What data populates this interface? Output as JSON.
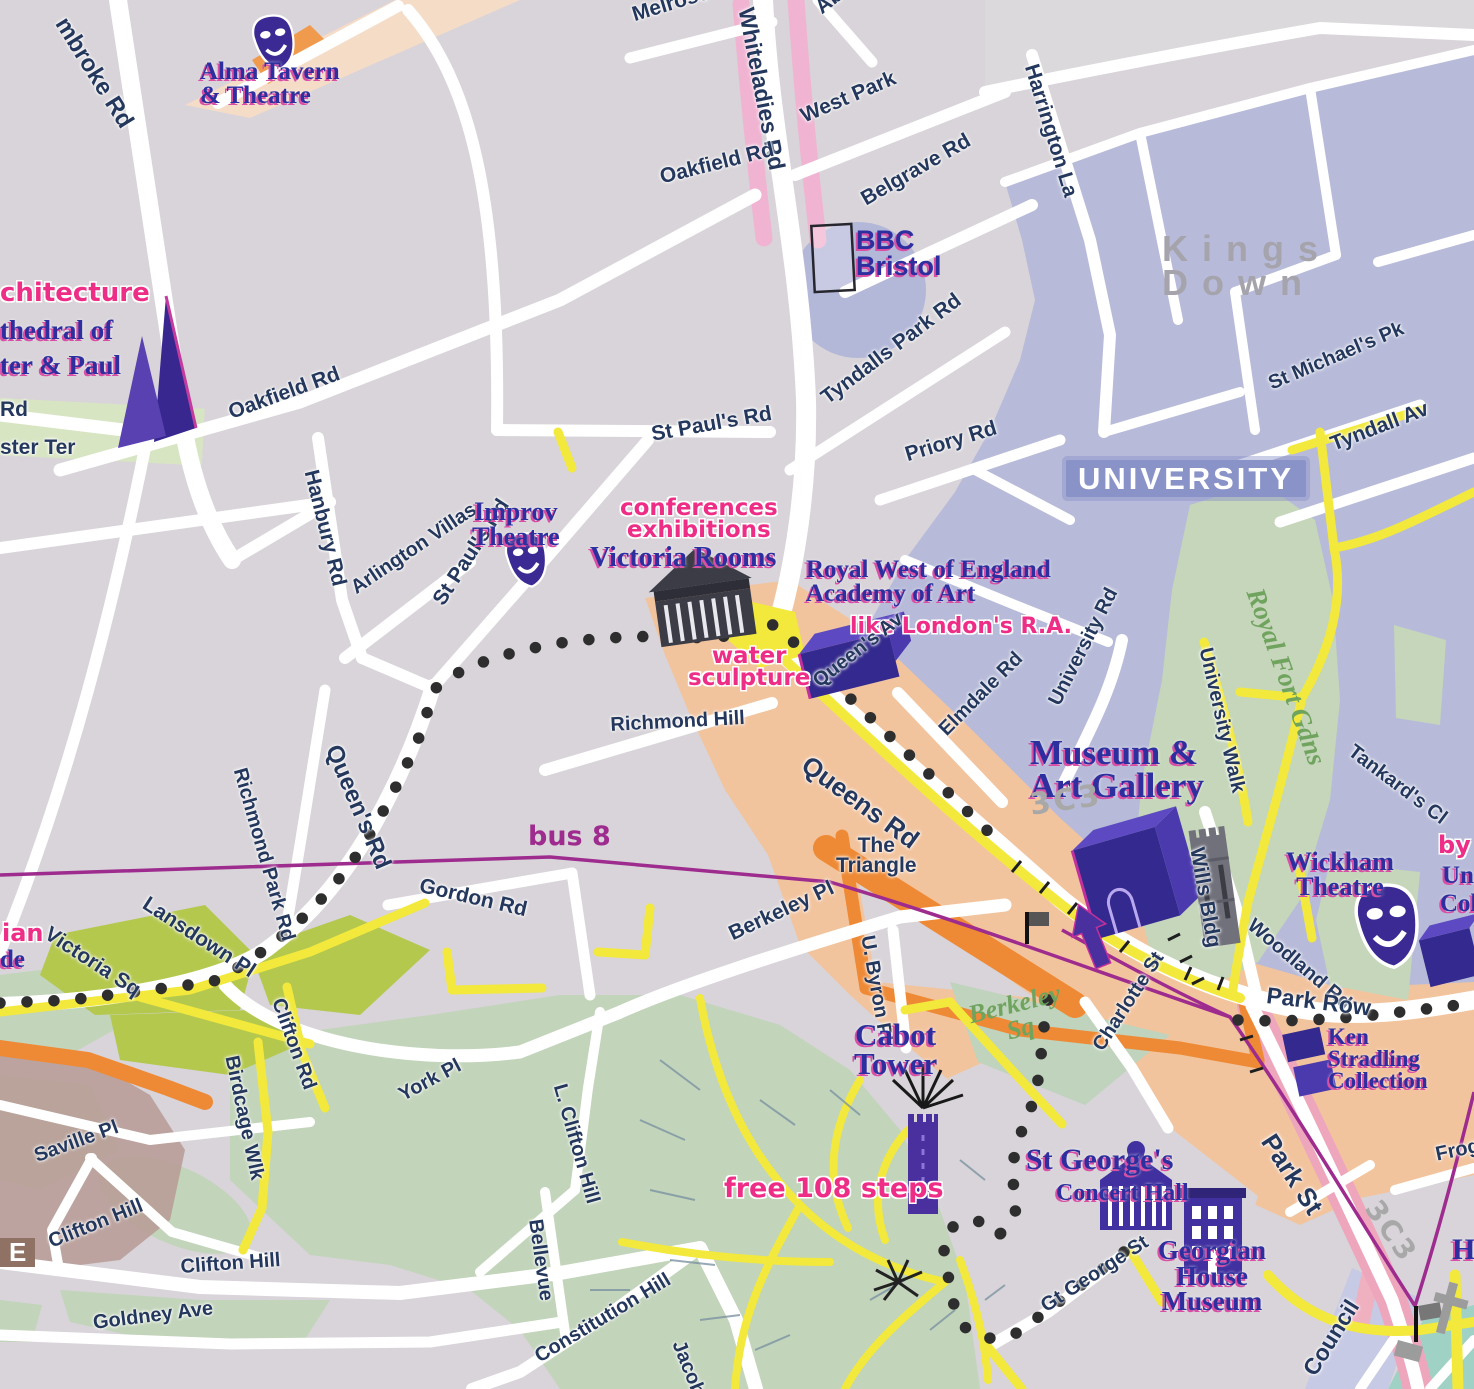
{
  "map": {
    "title": "Bristol visitor map — Clifton / University / Brandon Hill area",
    "colors": {
      "background": "#d8d4d9",
      "university_district": "#b7bbd9",
      "district_chip": "#8a93c8",
      "shopping_district": "#f2c49e",
      "park_green": "#c3d5bb",
      "square_olive": "#b5c84e",
      "road_white": "#ffffff",
      "road_yellow": "#f2e93c",
      "road_orange": "#ee8a35",
      "road_pink_shading": "#f0b4d2",
      "bus_route_purple": "#9e2b8e",
      "walking_trail_dots": "#2e2e2e",
      "poi_text_blue": "#2d2f9f",
      "poi_shadow_pink": "#d94fa5",
      "note_pink": "#ee2d87",
      "street_text_navy": "#24375c",
      "district_text_gray": "#a5a3ab",
      "building_icon_indigo": "#33298e"
    },
    "legend_icons": [
      "theatre-masks-icon",
      "cathedral-icon",
      "classical-building-icon",
      "3d-building-block-icon",
      "tower-icon",
      "viewpoint-starburst-icon",
      "bus-stop-flag-icon",
      "route-arrow-icon",
      "church-cross-icon"
    ],
    "routes": {
      "bus_route_label": "bus 8",
      "walking_trail_style": "black dotted line"
    },
    "labels": [
      {
        "n": "street-pembroke-rd",
        "t": "mbroke Rd",
        "x": 70,
        "y": 14,
        "r": 58,
        "c": "street-big",
        "s": 24
      },
      {
        "n": "poi-alma-tavern-theatre",
        "t": "Alma Tavern\n& Theatre",
        "x": 200,
        "y": 60,
        "r": 0,
        "c": "poi",
        "s": 25
      },
      {
        "n": "street-melrose-pl",
        "t": "Melrose Pl",
        "x": 630,
        "y": 6,
        "r": -17,
        "c": "street",
        "s": 21
      },
      {
        "n": "street-whiteladies-rd",
        "t": "Whiteladies Rd",
        "x": 756,
        "y": 6,
        "r": 79,
        "c": "street-big",
        "s": 23
      },
      {
        "n": "street-aberdeen-rd",
        "t": "Aberdeen",
        "x": 812,
        "y": 2,
        "r": -38,
        "c": "street",
        "s": 21
      },
      {
        "n": "street-west-park",
        "t": "West Park",
        "x": 798,
        "y": 108,
        "r": -23,
        "c": "street",
        "s": 21
      },
      {
        "n": "street-oakfield-rd-north",
        "t": "Oakfield Rd",
        "x": 658,
        "y": 168,
        "r": -14,
        "c": "street",
        "s": 21
      },
      {
        "n": "street-belgrave-rd",
        "t": "Belgrave Rd",
        "x": 858,
        "y": 192,
        "r": -30,
        "c": "street",
        "s": 21
      },
      {
        "n": "poi-bbc-bristol",
        "t": "BBC\nBristol",
        "x": 856,
        "y": 228,
        "r": 0,
        "c": "poi-sans",
        "s": 27
      },
      {
        "n": "street-harrington-la",
        "t": "Harrington La",
        "x": 1040,
        "y": 62,
        "r": 73,
        "c": "street",
        "s": 21
      },
      {
        "n": "district-kings-down",
        "t": "Kings Down",
        "x": 1162,
        "y": 232,
        "r": 0,
        "c": "district",
        "s": 36
      },
      {
        "n": "street-st-michaels-pk",
        "t": "St Michael's Pk",
        "x": 1266,
        "y": 376,
        "r": -23,
        "c": "street",
        "s": 20
      },
      {
        "n": "street-tyndall-av",
        "t": "Tyndall Av",
        "x": 1328,
        "y": 436,
        "r": -21,
        "c": "street",
        "s": 21
      },
      {
        "n": "note-architecture-partial",
        "t": "chitecture",
        "x": 0,
        "y": 281,
        "r": 0,
        "c": "pink",
        "s": 26
      },
      {
        "n": "poi-cathedral-line1",
        "t": "thedral of",
        "x": 0,
        "y": 318,
        "r": 0,
        "c": "poi",
        "s": 27
      },
      {
        "n": "poi-cathedral-line2",
        "t": "ter & Paul",
        "x": 0,
        "y": 353,
        "r": 0,
        "c": "poi",
        "s": 27
      },
      {
        "n": "street-rd-partial",
        "t": "Rd",
        "x": 0,
        "y": 400,
        "r": 0,
        "c": "street",
        "s": 21
      },
      {
        "n": "street-ster-ter-partial",
        "t": "ster Ter",
        "x": 0,
        "y": 438,
        "r": 0,
        "c": "street",
        "s": 21
      },
      {
        "n": "street-priory-rd",
        "t": "Priory Rd",
        "x": 903,
        "y": 446,
        "r": -17,
        "c": "street",
        "s": 21
      },
      {
        "n": "street-tyndalls-park-rd",
        "t": "Tyndalls Park Rd",
        "x": 818,
        "y": 392,
        "r": -37,
        "c": "street",
        "s": 21
      },
      {
        "n": "street-hanbury-rd",
        "t": "Hanbury Rd",
        "x": 320,
        "y": 468,
        "r": 76,
        "c": "street",
        "s": 21
      },
      {
        "n": "street-arlington-villas",
        "t": "Arlington Villas",
        "x": 348,
        "y": 582,
        "r": -34,
        "c": "street",
        "s": 20
      },
      {
        "n": "street-st-pauls-rd-west",
        "t": "St Paul's Rd",
        "x": 430,
        "y": 598,
        "r": -57,
        "c": "street",
        "s": 21
      },
      {
        "n": "street-st-pauls-rd-north",
        "t": "St Paul's Rd",
        "x": 650,
        "y": 425,
        "r": -10,
        "c": "street",
        "s": 21
      },
      {
        "n": "poi-improv-theatre",
        "t": "Improv\nTheatre",
        "x": 472,
        "y": 500,
        "r": 0,
        "c": "poi ctr",
        "s": 26
      },
      {
        "n": "note-conferences-exhibitions",
        "t": "conferences\nexhibitions",
        "x": 620,
        "y": 498,
        "r": 0,
        "c": "pink ctr",
        "s": 23
      },
      {
        "n": "poi-victoria-rooms",
        "t": "Victoria Rooms",
        "x": 590,
        "y": 545,
        "r": 0,
        "c": "poi",
        "s": 28
      },
      {
        "n": "poi-royal-west-academy",
        "t": "Royal West of England\nAcademy of Art",
        "x": 806,
        "y": 558,
        "r": 0,
        "c": "poi",
        "s": 25
      },
      {
        "n": "note-like-londons-ra",
        "t": "like London's R.A.",
        "x": 850,
        "y": 617,
        "r": 0,
        "c": "pink",
        "s": 22
      },
      {
        "n": "note-water-sculpture",
        "t": "water\nsculpture",
        "x": 688,
        "y": 646,
        "r": 0,
        "c": "pink ctr",
        "s": 23
      },
      {
        "n": "street-queens-av",
        "t": "Queen's Av",
        "x": 810,
        "y": 676,
        "r": -38,
        "c": "street",
        "s": 20
      },
      {
        "n": "street-richmond-hill",
        "t": "Richmond Hill",
        "x": 610,
        "y": 716,
        "r": -3,
        "c": "street",
        "s": 20
      },
      {
        "n": "street-elmdale-rd",
        "t": "Elmdale Rd",
        "x": 936,
        "y": 726,
        "r": -45,
        "c": "street",
        "s": 20
      },
      {
        "n": "street-university-rd",
        "t": "University Rd",
        "x": 1046,
        "y": 700,
        "r": -63,
        "c": "street",
        "s": 20
      },
      {
        "n": "street-university-walk",
        "t": "University Walk",
        "x": 1214,
        "y": 646,
        "r": 77,
        "c": "street",
        "s": 20
      },
      {
        "n": "park-royal-fort-gdns",
        "t": "Royal Fort Gdns",
        "x": 1266,
        "y": 585,
        "r": 70,
        "c": "green-it",
        "s": 27
      },
      {
        "n": "street-tankards-cl",
        "t": "Tankard's Cl",
        "x": 1356,
        "y": 742,
        "r": 37,
        "c": "street",
        "s": 20
      },
      {
        "n": "district-university-chip",
        "t": "UNIVERSITY",
        "x": 1066,
        "y": 460,
        "r": 0,
        "c": "chip",
        "s": 31
      },
      {
        "n": "poi-museum-art-gallery",
        "t": "Museum &\nArt Gallery",
        "x": 1030,
        "y": 736,
        "r": 0,
        "c": "poi",
        "s": 35
      },
      {
        "n": "street-queens-rd-diагonal",
        "t": "Queens Rd",
        "x": 812,
        "y": 752,
        "r": 36,
        "c": "street-big",
        "s": 26
      },
      {
        "n": "street-queens-rd-west",
        "t": "Queen's Rd",
        "x": 342,
        "y": 742,
        "r": 67,
        "c": "street-big",
        "s": 24
      },
      {
        "n": "street-richmond-park-rd",
        "t": "Richmond Park Rd",
        "x": 248,
        "y": 766,
        "r": 74,
        "c": "street",
        "s": 20
      },
      {
        "n": "street-lansdown-pl",
        "t": "Lansdown Pl",
        "x": 150,
        "y": 894,
        "r": 33,
        "c": "street",
        "s": 21
      },
      {
        "n": "street-victoria-sq",
        "t": "Victoria Sq",
        "x": 52,
        "y": 924,
        "r": 33,
        "c": "street",
        "s": 21
      },
      {
        "n": "note-ian-partial",
        "t": "ian",
        "x": 2,
        "y": 922,
        "r": 0,
        "c": "pink",
        "s": 24
      },
      {
        "n": "poi-de-partial",
        "t": "de",
        "x": 0,
        "y": 948,
        "r": 0,
        "c": "poi",
        "s": 25
      },
      {
        "n": "route-bus-8",
        "t": "bus 8",
        "x": 528,
        "y": 824,
        "r": 0,
        "c": "purple-lbl",
        "s": 27
      },
      {
        "n": "street-gordon-rd",
        "t": "Gordon Rd",
        "x": 422,
        "y": 876,
        "r": 13,
        "c": "street",
        "s": 21
      },
      {
        "n": "street-the-triangle",
        "t": "The\nTriangle",
        "x": 836,
        "y": 836,
        "r": 0,
        "c": "street ctr",
        "s": 21
      },
      {
        "n": "poi-wills-bldg",
        "t": "Wills Bldg",
        "x": 1206,
        "y": 846,
        "r": 80,
        "c": "street",
        "s": 21
      },
      {
        "n": "poi-wickham-theatre",
        "t": "Wickham\nTheatre",
        "x": 1286,
        "y": 850,
        "r": 0,
        "c": "poi ctr",
        "s": 26
      },
      {
        "n": "note-by-partial",
        "t": "by",
        "x": 1438,
        "y": 834,
        "r": 0,
        "c": "pink",
        "s": 24
      },
      {
        "n": "poi-un-partial",
        "t": "Un",
        "x": 1442,
        "y": 864,
        "r": 0,
        "c": "poi",
        "s": 25
      },
      {
        "n": "poi-col-partial",
        "t": "Col",
        "x": 1440,
        "y": 892,
        "r": 0,
        "c": "poi",
        "s": 25
      },
      {
        "n": "street-woodland-rd",
        "t": "Woodland Rd",
        "x": 1256,
        "y": 916,
        "r": 40,
        "c": "street",
        "s": 20
      },
      {
        "n": "street-park-row",
        "t": "Park Row",
        "x": 1268,
        "y": 985,
        "r": 7,
        "c": "street-big",
        "s": 23
      },
      {
        "n": "poi-ken-stradling",
        "t": "Ken\nStradling\nCollection",
        "x": 1328,
        "y": 1026,
        "r": 0,
        "c": "poi",
        "s": 23
      },
      {
        "n": "street-berkeley-pl",
        "t": "Berkeley Pl",
        "x": 726,
        "y": 926,
        "r": -25,
        "c": "street",
        "s": 21
      },
      {
        "n": "street-u-byron-pl",
        "t": "U. Byron Pl",
        "x": 876,
        "y": 934,
        "r": 80,
        "c": "street",
        "s": 20
      },
      {
        "n": "poi-cabot-tower",
        "t": "Cabot\nTower",
        "x": 854,
        "y": 1020,
        "r": 0,
        "c": "poi ctr",
        "s": 31
      },
      {
        "n": "park-berkeley-sq",
        "t": "Berkeley\nSq",
        "x": 966,
        "y": 1004,
        "r": -14,
        "c": "green-it ctr",
        "s": 26
      },
      {
        "n": "street-charlotte-st",
        "t": "Charlotte St",
        "x": 1090,
        "y": 1044,
        "r": -57,
        "c": "street",
        "s": 20
      },
      {
        "n": "street-clifton-rd",
        "t": "Clifton Rd",
        "x": 286,
        "y": 996,
        "r": 70,
        "c": "street",
        "s": 20
      },
      {
        "n": "street-birdcage-wlk",
        "t": "Birdcage Wlk",
        "x": 240,
        "y": 1054,
        "r": 78,
        "c": "street",
        "s": 20
      },
      {
        "n": "street-york-pl",
        "t": "York Pl",
        "x": 396,
        "y": 1088,
        "r": -28,
        "c": "street",
        "s": 20
      },
      {
        "n": "street-saville-pl",
        "t": "Saville Pl",
        "x": 32,
        "y": 1148,
        "r": -20,
        "c": "street",
        "s": 20
      },
      {
        "n": "street-clifton-hill-west",
        "t": "Clifton Hill",
        "x": 46,
        "y": 1234,
        "r": -22,
        "c": "street",
        "s": 20
      },
      {
        "n": "street-clifton-hill-east",
        "t": "Clifton Hill",
        "x": 180,
        "y": 1258,
        "r": -4,
        "c": "street",
        "s": 20
      },
      {
        "n": "street-goldney-ave",
        "t": "Goldney Ave",
        "x": 92,
        "y": 1314,
        "r": -7,
        "c": "street",
        "s": 20
      },
      {
        "n": "street-l-clifton-hill",
        "t": "L. Clifton Hill",
        "x": 568,
        "y": 1082,
        "r": 74,
        "c": "street",
        "s": 20
      },
      {
        "n": "street-bellevue",
        "t": "Bellevue",
        "x": 544,
        "y": 1218,
        "r": 82,
        "c": "street",
        "s": 20
      },
      {
        "n": "street-constitution-hill",
        "t": "Constitution Hill",
        "x": 532,
        "y": 1350,
        "r": -31,
        "c": "street",
        "s": 20
      },
      {
        "n": "street-jacob-partial",
        "t": "Jacob",
        "x": 686,
        "y": 1338,
        "r": 68,
        "c": "street",
        "s": 20
      },
      {
        "n": "note-free-108-steps",
        "t": "free 108 steps",
        "x": 724,
        "y": 1176,
        "r": 0,
        "c": "pink",
        "s": 27
      },
      {
        "n": "poi-st-georges",
        "t": "St George's",
        "x": 1026,
        "y": 1146,
        "r": 0,
        "c": "poi",
        "s": 30
      },
      {
        "n": "poi-concert-hall",
        "t": "Concert Hall",
        "x": 1056,
        "y": 1182,
        "r": 0,
        "c": "poi",
        "s": 24
      },
      {
        "n": "poi-georgian-house-museum",
        "t": "Georgian\nHouse\nMuseum",
        "x": 1158,
        "y": 1238,
        "r": 0,
        "c": "poi ctr",
        "s": 27
      },
      {
        "n": "street-gt-george-st",
        "t": "Gt George St",
        "x": 1038,
        "y": 1300,
        "r": -33,
        "c": "street",
        "s": 20
      },
      {
        "n": "street-park-st",
        "t": "Park St",
        "x": 1278,
        "y": 1130,
        "r": 57,
        "c": "street-big",
        "s": 26
      },
      {
        "n": "street-frog-partial",
        "t": "Frog",
        "x": 1434,
        "y": 1146,
        "r": -12,
        "c": "street",
        "s": 20
      },
      {
        "n": "street-council-partial",
        "t": "Council",
        "x": 1300,
        "y": 1368,
        "r": -58,
        "c": "street-big",
        "s": 23
      },
      {
        "n": "poi-h-partial",
        "t": "H",
        "x": 1452,
        "y": 1236,
        "r": 0,
        "c": "poi",
        "s": 30
      },
      {
        "n": "chip-e-partial",
        "t": "E",
        "x": 0,
        "y": 1238,
        "r": 0,
        "c": "chip-brown",
        "s": 26
      },
      {
        "n": "glyph-museum-logo",
        "t": "3C3",
        "x": 1028,
        "y": 792,
        "r": -8,
        "c": "gray-glyph",
        "s": 30
      },
      {
        "n": "glyph-park-st-logo",
        "t": "3C3",
        "x": 1382,
        "y": 1196,
        "r": 55,
        "c": "gray-glyph",
        "s": 28
      },
      {
        "n": "street-oakfield-rd-west",
        "t": "Oakfield Rd",
        "x": 226,
        "y": 404,
        "r": -20,
        "c": "street",
        "s": 21
      }
    ]
  }
}
